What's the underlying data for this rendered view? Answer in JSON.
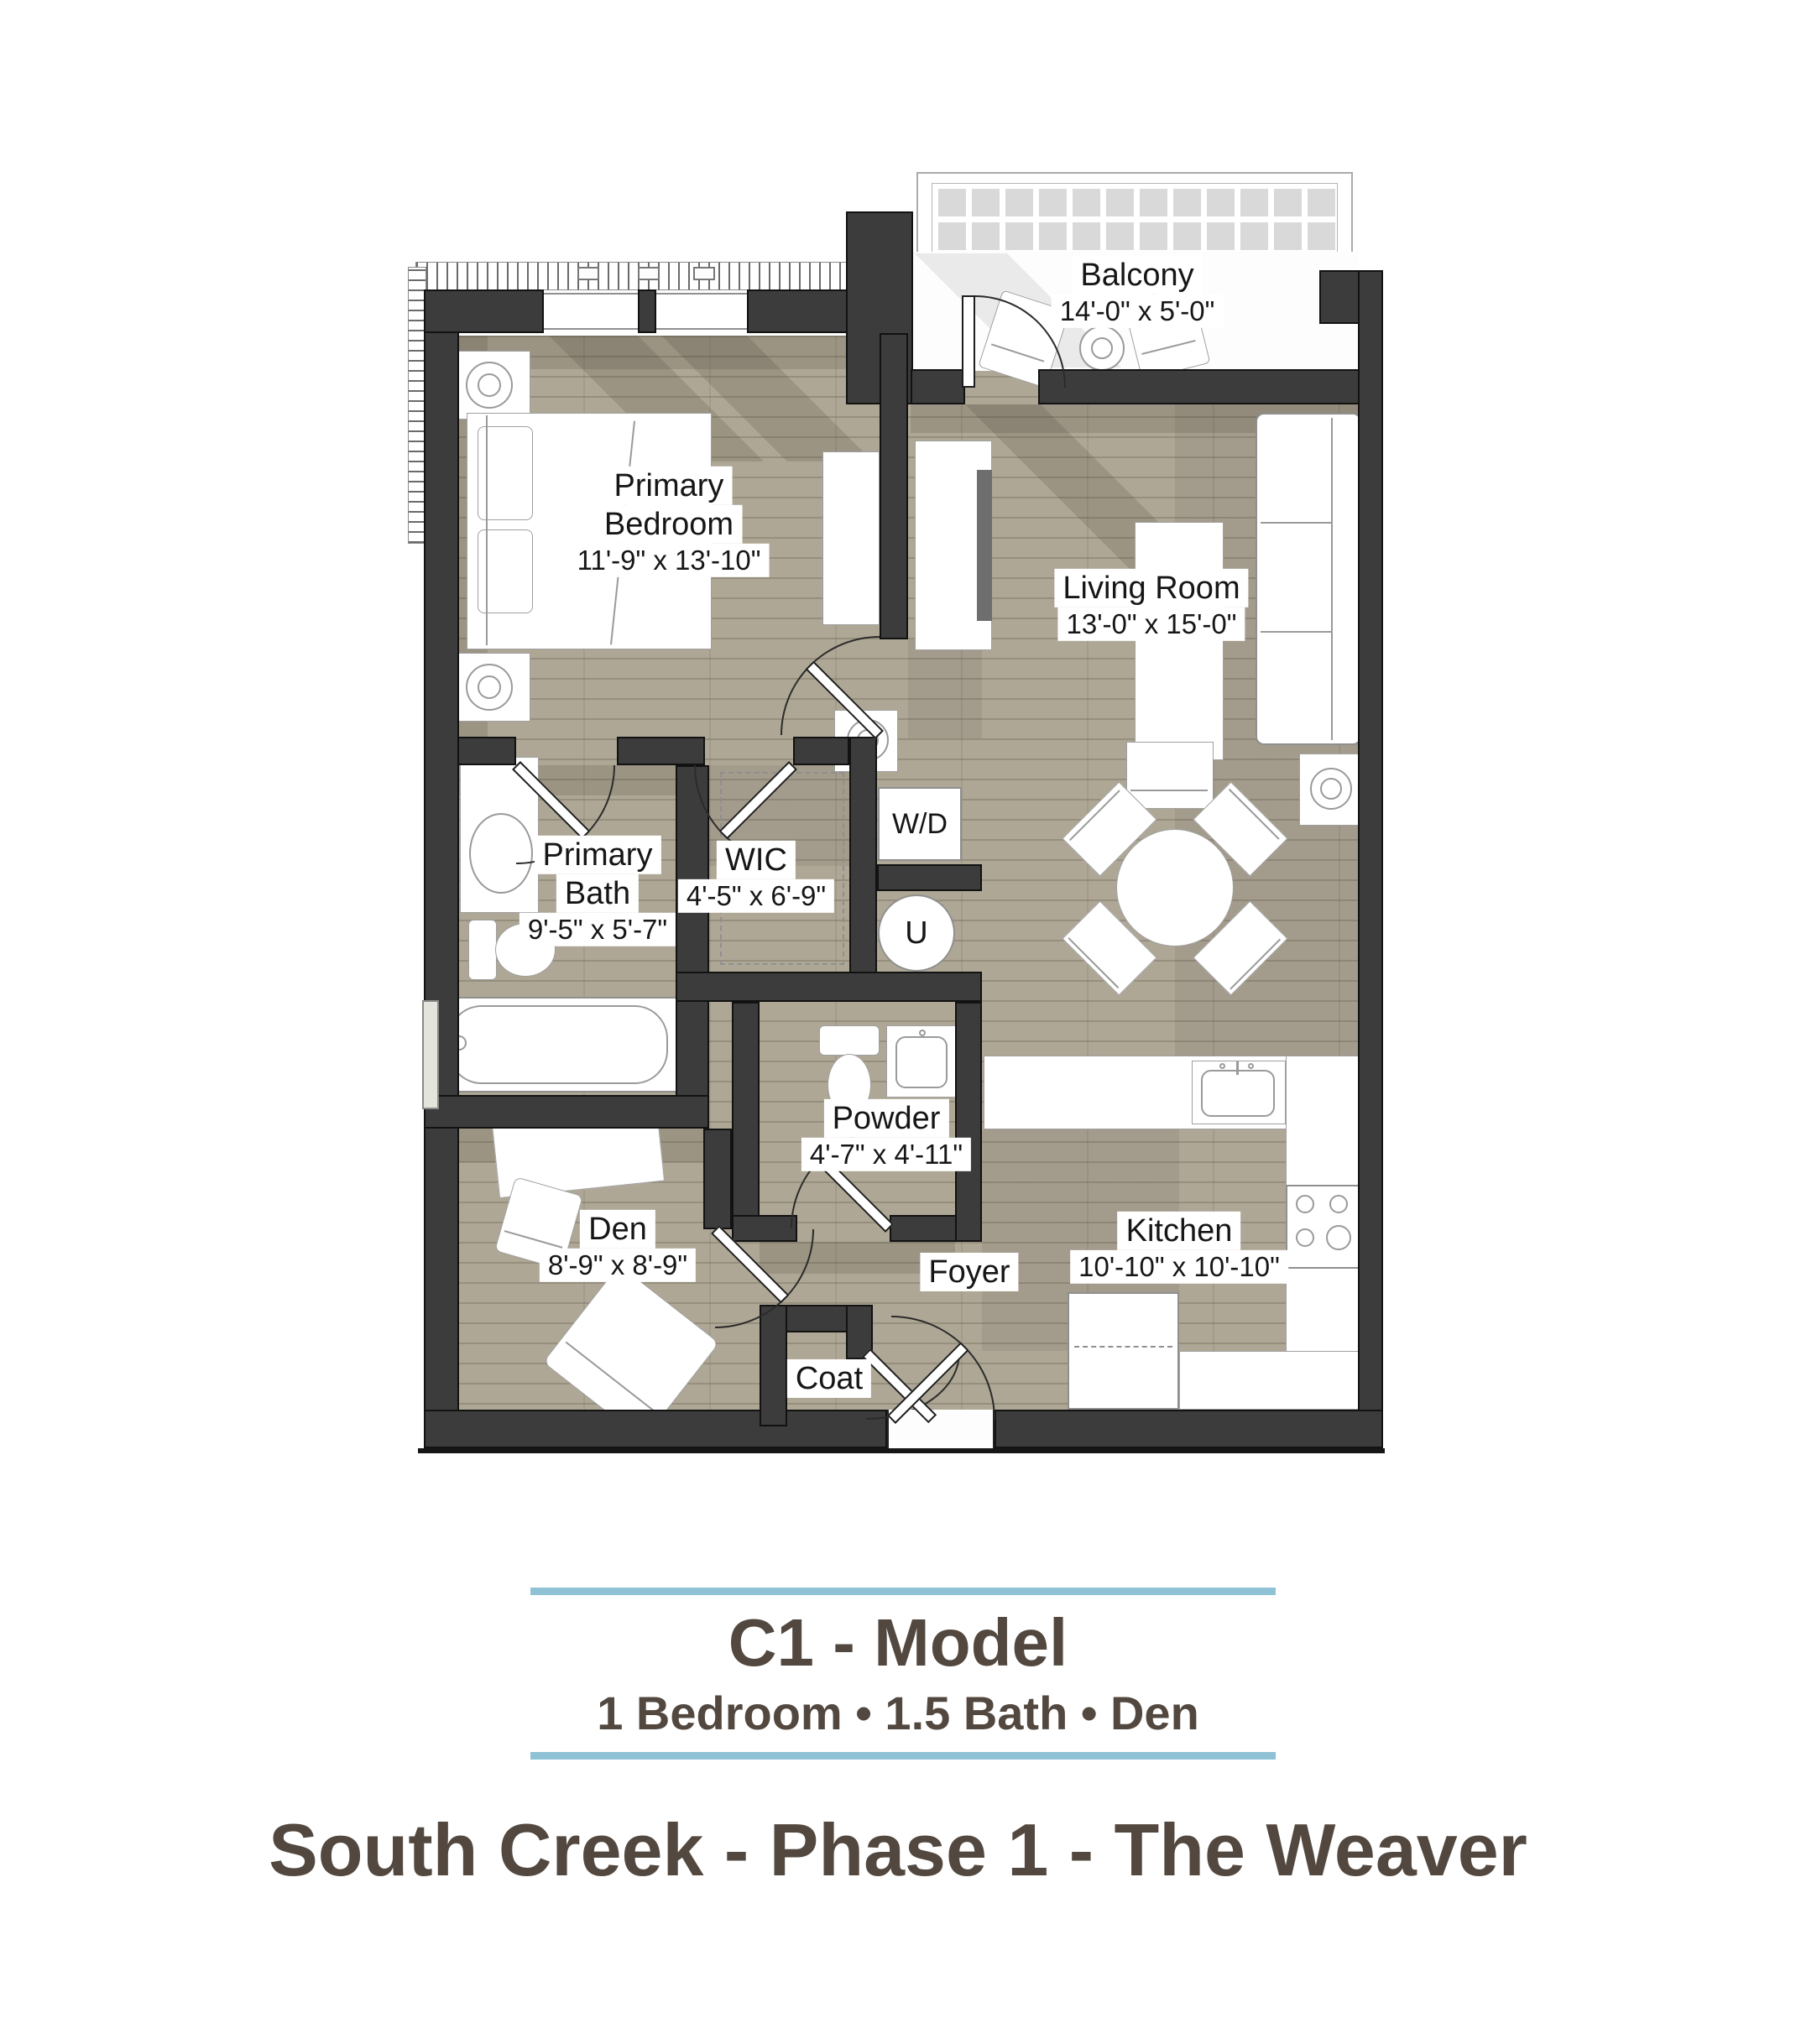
{
  "plan": {
    "rooms": {
      "balcony": {
        "name": "Balcony",
        "dims": "14'-0\" x 5'-0\""
      },
      "primary_bedroom": {
        "name_line1": "Primary",
        "name_line2": "Bedroom",
        "dims": "11'-9\" x 13'-10\""
      },
      "living_room": {
        "name": "Living Room",
        "dims": "13'-0\" x 15'-0\""
      },
      "primary_bath": {
        "name_line1": "Primary",
        "name_line2": "Bath",
        "dims": "9'-5\" x 5'-7\""
      },
      "wic": {
        "name": "WIC",
        "dims": "4'-5\" x 6'-9\""
      },
      "powder": {
        "name": "Powder",
        "dims": "4'-7\" x 4'-11\""
      },
      "den": {
        "name": "Den",
        "dims": "8'-9\" x 8'-9\""
      },
      "kitchen": {
        "name": "Kitchen",
        "dims": "10'-10\" x 10'-10\""
      },
      "foyer": {
        "name": "Foyer"
      },
      "coat": {
        "name": "Coat"
      }
    },
    "appliances": {
      "washer_dryer": "W/D",
      "utility": "U"
    },
    "colors": {
      "wall": "#3c3c3c",
      "floor": "#aea795"
    }
  },
  "footer": {
    "unit_title": "C1 - Model",
    "unit_subtitle": "1 Bedroom • 1.5 Bath • Den",
    "project_title": "South Creek - Phase 1 - The Weaver",
    "rule_color": "#8fc2d5",
    "text_color": "#52483f"
  }
}
